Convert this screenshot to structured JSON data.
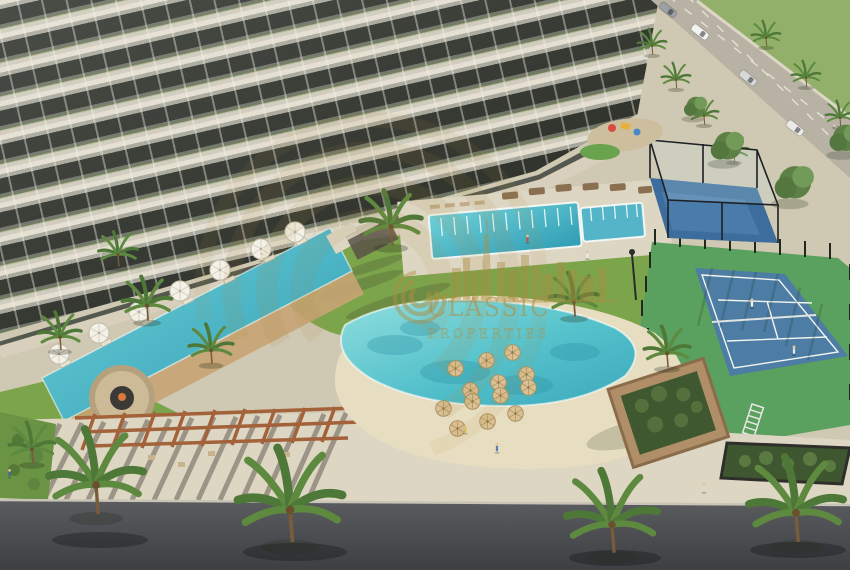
{
  "scene": {
    "watermark": {
      "line1": "CLASSIC",
      "line2": "PROPERTIES"
    },
    "palette": {
      "building_light": "#e3ded0",
      "building_glass": "#31352e",
      "paving": "#cfc8b2",
      "paving_light": "#ddd6c3",
      "sand": "#e7ddc1",
      "lawn": "#7ca44b",
      "field": "#93b06a",
      "pool": "#35a7ba",
      "lagoon": "#54c1cb",
      "court_blue": "#4d7da4",
      "court_green": "#5aa05e",
      "padel_blue": "#3d6d9c",
      "road_asphalt": "#46484c",
      "road_top": "#b7b2a3",
      "wood": "#b4875a",
      "pergola_wood": "#a4623a",
      "umbrella_white": "#f4f1e8",
      "umbrella_thatch": "#d9c195",
      "palm_green": "#4e7838",
      "watermark_gold": "#ad8d41"
    }
  }
}
